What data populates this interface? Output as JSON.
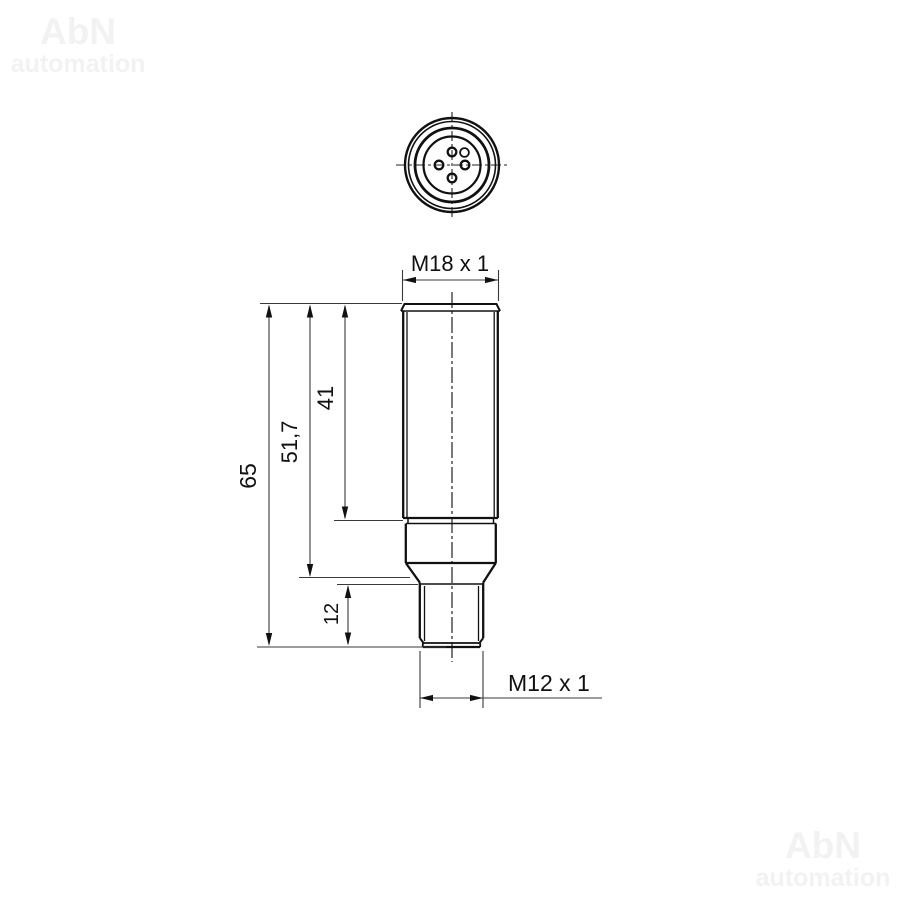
{
  "watermark": {
    "brand": "AbN",
    "subtitle": "automation",
    "color": "#f2f2f2"
  },
  "drawing": {
    "labels": {
      "thread_top": "M18 x 1",
      "thread_bottom": "M12 x 1",
      "dim_total_length": "65",
      "dim_body_length": "51,7",
      "dim_thread_length": "41",
      "dim_connector_length": "12"
    },
    "colors": {
      "object_line": "#111111",
      "dim_line": "#3a3a3a",
      "background": "#ffffff"
    }
  }
}
